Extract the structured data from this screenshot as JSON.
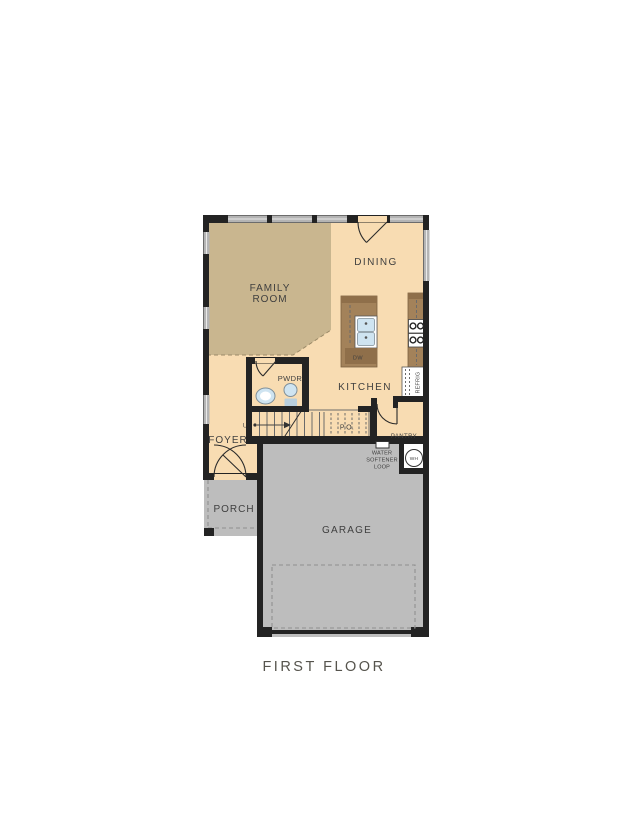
{
  "title": "FIRST FLOOR",
  "labels": {
    "family_room_line1": "FAMILY",
    "family_room_line2": "ROOM",
    "dining": "DINING",
    "kitchen": "KITCHEN",
    "pwdr": "PWDR",
    "foyer": "FOYER",
    "porch": "PORCH",
    "garage": "GARAGE",
    "pantry": "PANTRY",
    "pocket_office": "P.O.",
    "up": "UP",
    "dishwasher": "DW",
    "refrigerator": "REFRIG",
    "water_heater": "WH",
    "water_softener_line1": "WATER",
    "water_softener_line2": "SOFTENER",
    "water_softener_line3": "LOOP"
  },
  "colors": {
    "background": "#ffffff",
    "wall": "#232323",
    "floor": "#f8dcb2",
    "family_room_floor": "#c9b68f",
    "exterior_concrete": "#bdbdbd",
    "counter": "#a3825a",
    "counter_dark": "#8f6f4a",
    "window": "#b4b4b4",
    "fixture_blue": "#cfe4f1",
    "label_text": "#3f3f3f",
    "title_text": "#56544d"
  }
}
